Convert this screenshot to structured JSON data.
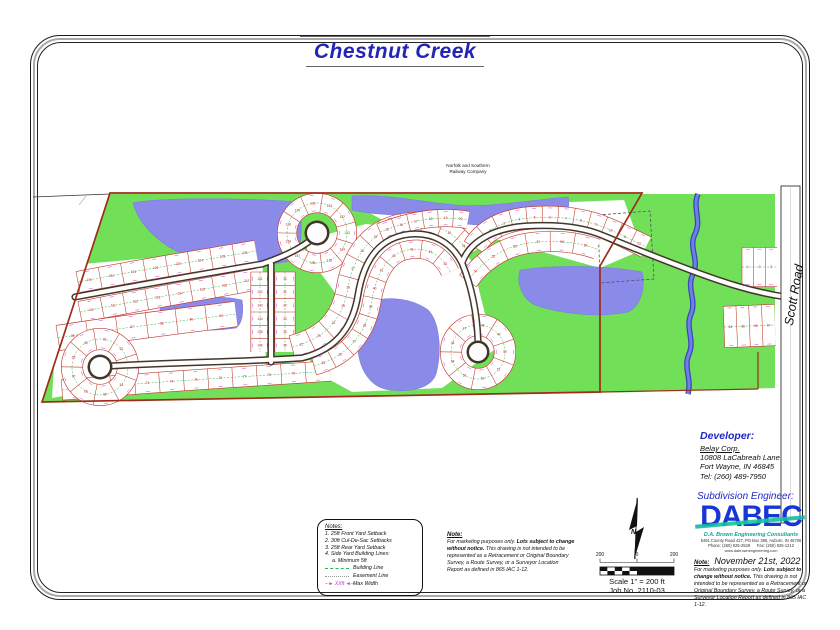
{
  "title": "Chestnut Creek",
  "rail": {
    "line1": "Norfolk and Southern",
    "line2": "Railway Company"
  },
  "scott_road_label": "Scott Road",
  "notes_box": {
    "heading": "Notes:",
    "items": [
      "1. 25ft Front Yard Setback",
      "2. 30ft Cul-De-Sac Setbacks",
      "3. 25ft Rear Yard Setback",
      "4. Side Yard Building Lines:",
      "a. Minimum 5ft"
    ],
    "legend": [
      {
        "label": "Building Line"
      },
      {
        "label": "Easement Line"
      },
      {
        "label": "Max Width",
        "sample": "─► XXft ◄─"
      }
    ]
  },
  "disclaimer": {
    "heading": "Note:",
    "pre": "For marketing purposes only.  ",
    "bold": "Lots subject to change without notice.",
    "post": "  This drawing is not intended to be represented as a Retracement or Original Boundary Survey, a Route Survey, or a Surveyor Location Report as defined in 865 IAC 1-12."
  },
  "scale": {
    "left": "200",
    "zero": "0",
    "right": "200",
    "caption1": "Scale 1\" = 200 ft",
    "caption2": "Job No. 2110-03"
  },
  "developer": {
    "heading": "Developer:",
    "name": "Belay Corp.",
    "addr1": "10808 LaCabreah Lane",
    "addr2": "Fort Wayne, IN 46845",
    "tel": "Tel: (260) 489-7950"
  },
  "engineer_heading": "Subdivision Engineer:",
  "dabec": {
    "word": "DABEC",
    "sub": "D.A. Brown Engineering Consultants",
    "addr": "5491 County Road 427, PO Box 389, Auburn, IN  46706",
    "phones": "Phone: (260) 925-2528      Fax: (260) 925-1212",
    "web": "www.dabrownengineering.com"
  },
  "date_note": {
    "date": "November 21st, 2022"
  },
  "map": {
    "palette": {
      "green": "#72df58",
      "pond": "#8a8ae9",
      "pond_edge": "#7b7bdf",
      "creek": "#6f7fe6",
      "creek_edge": "#3947b8",
      "road_casing": "#42362a",
      "lot_line": "#bf3a2a",
      "lot_num": "#c52222",
      "dim": "#cf3fcf",
      "building_line": "#2fb24f",
      "boundary": "#9e2c18"
    },
    "green": "110,194 775,194 775,388 640,392 42,402",
    "fields": [
      "60,266 262,248 266,366 310,360 314,376 120,386 52,398",
      "306,240 366,224 452,234 472,262 494,350 442,388 352,392 312,370 342,302 308,256",
      "364,210 624,200 642,250 600,268 500,240 420,240"
    ],
    "ponds": [
      "M 133 203 C 160 197 250 198 298 202 C 303 220 302 245 296 260 C 260 268 215 266 188 256 C 165 248 140 228 133 203 Z",
      "M 352 196 C 390 194 420 202 455 205 C 490 208 530 200 568 197 C 570 207 568 216 560 220 C 520 230 470 226 440 220 C 410 214 375 216 352 210 Z",
      "M 520 270 C 560 264 610 266 642 272 C 646 290 640 306 628 312 C 600 318 560 314 535 305 C 522 298 516 283 520 270 Z",
      "M 368 302 C 388 296 412 298 428 310 C 440 322 442 352 436 374 C 430 390 408 392 390 390 C 372 388 360 372 358 350 C 357 330 360 312 368 302 Z",
      "M 162 299 C 190 295 225 296 242 300 C 244 312 242 324 236 328 C 210 332 182 330 168 324 C 160 318 158 308 162 299 Z"
    ],
    "creek": "M 698 194 C 692 208 702 220 695 234 C 688 248 700 260 693 274 C 686 288 697 300 691 314 C 685 328 695 340 689 354 C 683 368 692 378 688 394",
    "dashed_parcel": "598,215 650,211 654,279 600,283",
    "blocks": [
      {
        "d": "M 78 282 C 150 268 210 259 256 251",
        "w": 22,
        "n": 8,
        "s": 119
      },
      {
        "d": "M 80 312 C 150 298 212 288 258 279",
        "w": 22,
        "n": 8,
        "s": 110
      },
      {
        "d": "M 287 233 a 30 30 0 1 1 60 0 a 30 30 0 1 1 -60 0",
        "w": 20,
        "n": 11,
        "s": 128
      },
      {
        "d": "M 58 338 C 120 328 180 321 236 314",
        "w": 26,
        "n": 6,
        "s": 85
      },
      {
        "d": "M 62 390 C 150 382 240 377 330 371",
        "w": 21,
        "n": 11,
        "s": 70
      },
      {
        "d": "M 285 272 L 285 352",
        "w": 21,
        "n": 6,
        "s": 30
      },
      {
        "d": "M 260 272 L 260 352",
        "w": 19,
        "n": 6,
        "s": 141
      },
      {
        "d": "M 72 367 a 28 28 0 1 1 56 0 a 28 28 0 1 1 -56 0",
        "w": 22,
        "n": 9,
        "s": 59
      },
      {
        "d": "M 292 347 C 332 337 344 312 348 288 C 354 252 374 230 404 225 C 436 220 458 234 469 254",
        "w": 24,
        "n": 13,
        "s": 22
      },
      {
        "d": "M 314 366 C 354 355 368 326 372 300 C 378 268 390 253 408 250 C 428 246 443 256 450 272",
        "w": 19,
        "n": 11,
        "s": 35
      },
      {
        "d": "M 474 247 C 484 230 504 220 530 218 C 562 215 590 221 608 229 C 622 235 634 241 646 247",
        "w": 23,
        "n": 12,
        "s": 1
      },
      {
        "d": "M 468 281 C 481 262 502 247 529 243 C 557 239 580 243 597 249",
        "w": 21,
        "n": 6,
        "s": 54
      },
      {
        "d": "M 451 352 a 27 27 0 1 1 54 0 a 27 27 0 1 1 -54 0",
        "w": 22,
        "n": 9,
        "s": 46
      },
      {
        "d": "M 380 232 C 410 220 440 215 468 220",
        "w": 18,
        "n": 6,
        "s": 15
      },
      {
        "d": "M 742 267 L 777 267",
        "w": 40,
        "n": 3,
        "s": 1
      },
      {
        "d": "M 724 327 L 775 325",
        "w": 42,
        "n": 4,
        "s": 64
      }
    ],
    "roads": [
      "M 75 297 C 150 283 215 272 262 264",
      "M 262 264 C 286 256 302 247 311 240",
      "M 271 264 L 271 362",
      "M 110 366 C 180 362 240 362 302 358",
      "M 302 358 C 342 348 354 320 358 295 C 364 258 380 240 404 235 C 432 230 452 243 462 263 C 471 285 477 312 478 341",
      "M 462 263 C 470 240 496 228 526 226 C 560 224 586 228 604 236 C 628 246 658 258 690 270 C 722 282 752 292 786 297"
    ],
    "culdesacs": [
      [
        100,
        367,
        11
      ],
      [
        317,
        233,
        11
      ],
      [
        478,
        352,
        10
      ]
    ],
    "boundary": "110,193 642,193 600,266 600,392 42,402",
    "boundary_extras": [
      "M 600 392 L 758 389",
      "M 758 389 L 758 352"
    ],
    "rail_line": "M 33 197 L 110 194",
    "rail_leader": "M 86 196 L 79 205",
    "scott": {
      "x": 781,
      "y": 186,
      "w": 19,
      "h": 337
    }
  }
}
